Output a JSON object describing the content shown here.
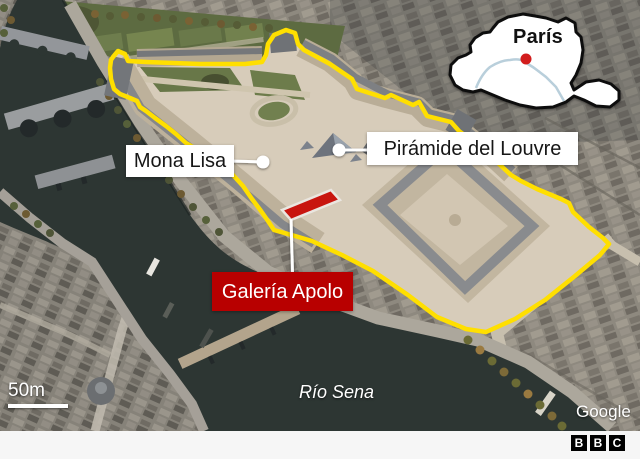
{
  "map": {
    "labels": {
      "mona_lisa": "Mona Lisa",
      "piramide": "Pirámide del Louvre",
      "galeria_apolo": "Galería Apolo"
    },
    "river_label": "Río Sena",
    "scale_label": "50m",
    "attribution": "Google"
  },
  "inset": {
    "title": "París"
  },
  "footer": {
    "logo": [
      "B",
      "B",
      "C"
    ]
  },
  "colors": {
    "accent_yellow": "#ffdf00",
    "bbc_red": "#b80000",
    "highlight_red": "#c8150f",
    "inset_dot_red": "#d21d1d",
    "seine_blue": "#b9cfdb",
    "footer_bg": "#f6f6f6"
  }
}
